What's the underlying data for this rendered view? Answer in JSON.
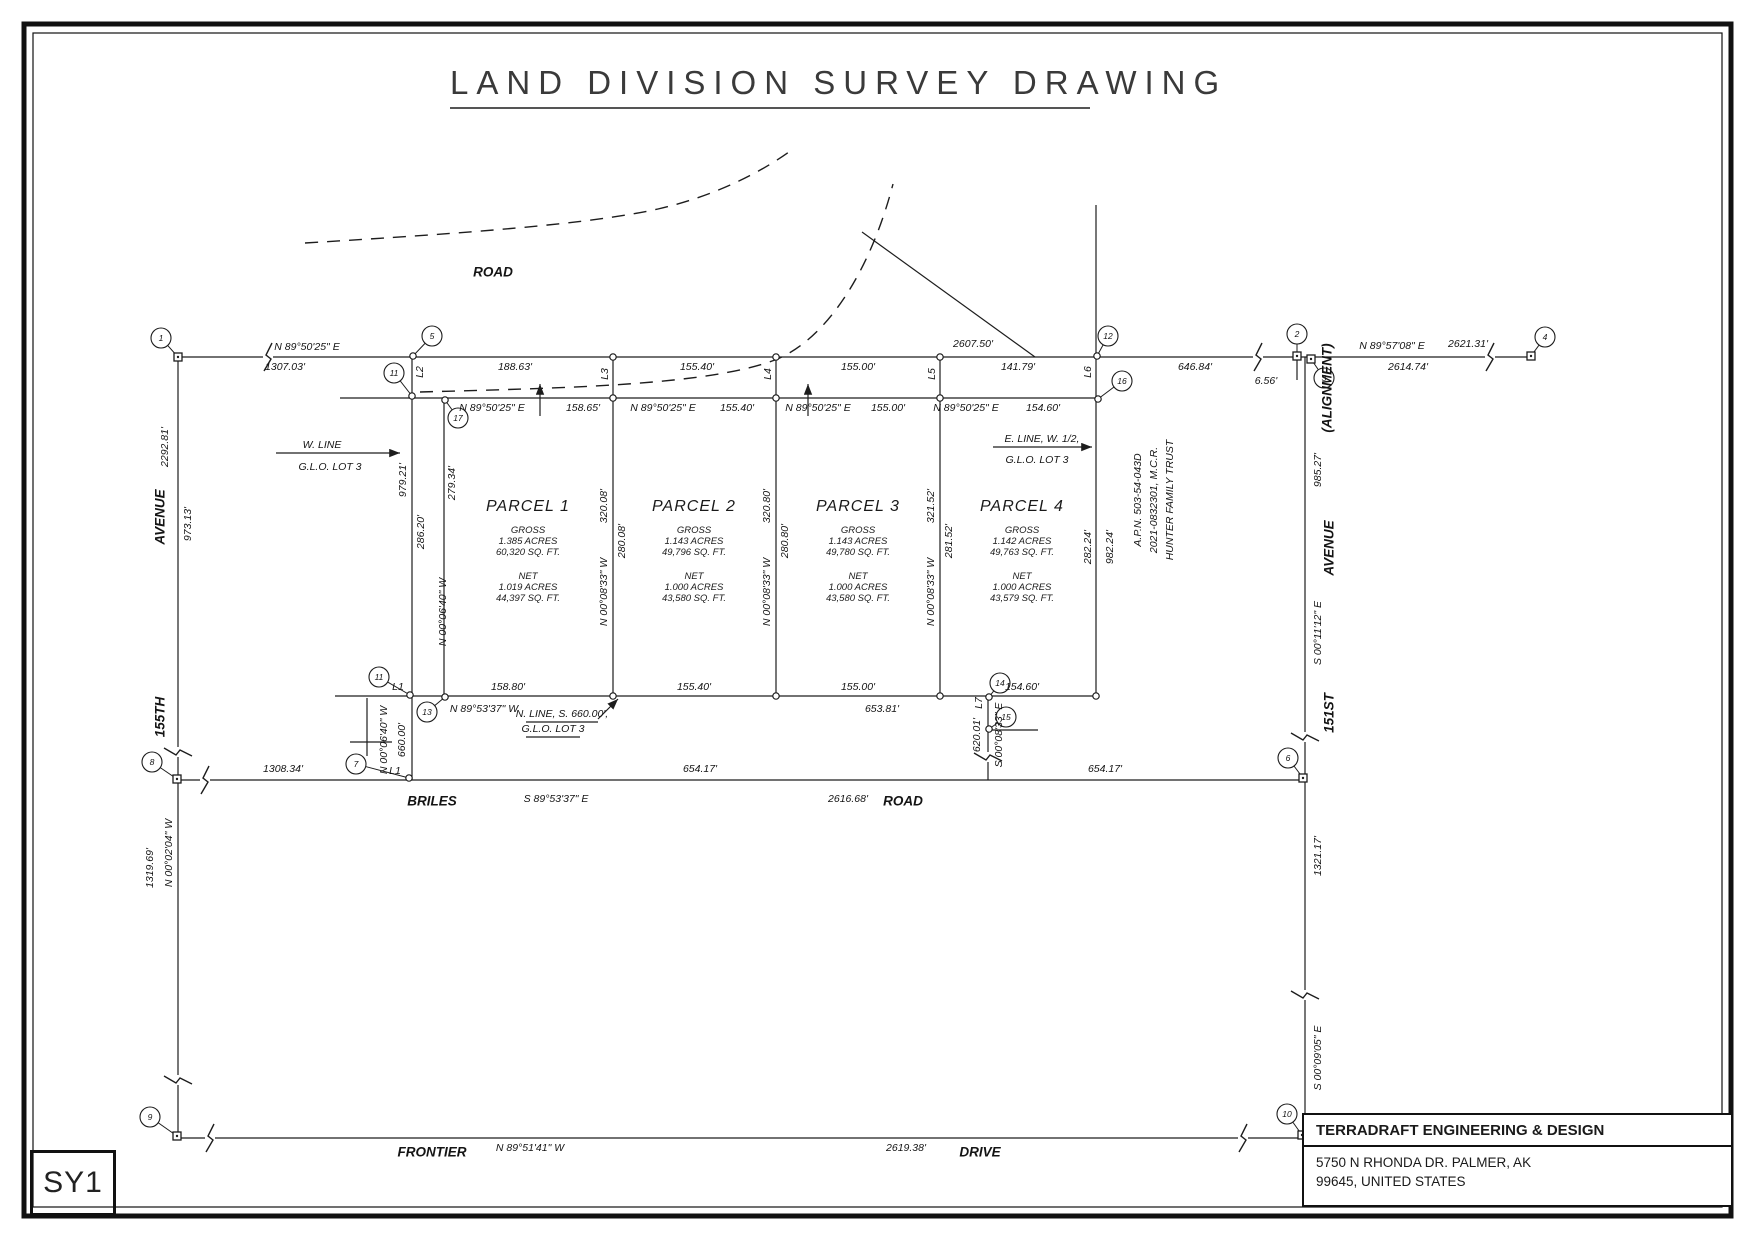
{
  "title": "LAND DIVISION SURVEY DRAWING",
  "sheet_id": "SY1",
  "title_block": {
    "company": "TERRADRAFT ENGINEERING & DESIGN",
    "address_line1": "5750 N RHONDA DR. PALMER, AK",
    "address_line2": "99645, UNITED STATES"
  },
  "colors": {
    "ink": "#1d1d1d",
    "paper": "#ffffff"
  },
  "parcels": [
    {
      "name": "PARCEL 1",
      "cx": 528,
      "gross": [
        "GROSS",
        "1.385 ACRES",
        "60,320 SQ. FT."
      ],
      "net": [
        "NET",
        "1.019 ACRES",
        "44,397 SQ. FT."
      ]
    },
    {
      "name": "PARCEL 2",
      "cx": 694,
      "gross": [
        "GROSS",
        "1.143 ACRES",
        "49,796 SQ. FT."
      ],
      "net": [
        "NET",
        "1.000 ACRES",
        "43,580 SQ. FT."
      ]
    },
    {
      "name": "PARCEL 3",
      "cx": 858,
      "gross": [
        "GROSS",
        "1.143 ACRES",
        "49,780 SQ. FT."
      ],
      "net": [
        "NET",
        "1.000 ACRES",
        "43,580 SQ. FT."
      ]
    },
    {
      "name": "PARCEL 4",
      "cx": 1022,
      "gross": [
        "GROSS",
        "1.142 ACRES",
        "49,763 SQ. FT."
      ],
      "net": [
        "NET",
        "1.000 ACRES",
        "43,579 SQ. FT."
      ]
    }
  ],
  "labels": [
    {
      "t": "ROAD",
      "x": 493,
      "y": 272,
      "c": "road",
      "n": "road-label-top"
    },
    {
      "t": "N 89°50'25\" E",
      "x": 307,
      "y": 347
    },
    {
      "t": "1307.03'",
      "x": 285,
      "y": 367
    },
    {
      "t": "188.63'",
      "x": 515,
      "y": 367
    },
    {
      "t": "155.40'",
      "x": 697,
      "y": 367
    },
    {
      "t": "155.00'",
      "x": 858,
      "y": 367
    },
    {
      "t": "141.79'",
      "x": 1018,
      "y": 367
    },
    {
      "t": "2607.50'",
      "x": 973,
      "y": 344
    },
    {
      "t": "646.84'",
      "x": 1195,
      "y": 367
    },
    {
      "t": "N 89°57'08\" E",
      "x": 1392,
      "y": 346
    },
    {
      "t": "2621.31'",
      "x": 1468,
      "y": 344
    },
    {
      "t": "2614.74'",
      "x": 1408,
      "y": 367
    },
    {
      "t": "6.56'",
      "x": 1266,
      "y": 381
    },
    {
      "t": "N 89°50'25\" E",
      "x": 492,
      "y": 408
    },
    {
      "t": "158.65'",
      "x": 583,
      "y": 408
    },
    {
      "t": "N 89°50'25\" E",
      "x": 663,
      "y": 408
    },
    {
      "t": "155.40'",
      "x": 737,
      "y": 408
    },
    {
      "t": "N 89°50'25\" E",
      "x": 818,
      "y": 408
    },
    {
      "t": "155.00'",
      "x": 888,
      "y": 408
    },
    {
      "t": "N 89°50'25\" E",
      "x": 966,
      "y": 408
    },
    {
      "t": "154.60'",
      "x": 1043,
      "y": 408
    },
    {
      "t": "L2",
      "x": 420,
      "y": 372,
      "r": 1
    },
    {
      "t": "L3",
      "x": 605,
      "y": 374,
      "r": 1
    },
    {
      "t": "L4",
      "x": 768,
      "y": 374,
      "r": 1
    },
    {
      "t": "L5",
      "x": 932,
      "y": 374,
      "r": 1
    },
    {
      "t": "L6",
      "x": 1088,
      "y": 372,
      "r": 1
    },
    {
      "t": "W. LINE",
      "x": 322,
      "y": 445
    },
    {
      "t": "G.L.O.  LOT 3",
      "x": 330,
      "y": 467
    },
    {
      "t": "E. LINE, W. 1/2,",
      "x": 1042,
      "y": 439
    },
    {
      "t": "G.L.O.  LOT 3",
      "x": 1037,
      "y": 460
    },
    {
      "t": "N. LINE, S. 660.00',",
      "x": 562,
      "y": 714
    },
    {
      "t": "G.L.O. LOT 3",
      "x": 553,
      "y": 729
    },
    {
      "t": "979.21'",
      "x": 403,
      "y": 480,
      "r": 1
    },
    {
      "t": "286.20'",
      "x": 421,
      "y": 532,
      "r": 1
    },
    {
      "t": "279.34'",
      "x": 452,
      "y": 483,
      "r": 1
    },
    {
      "t": "N 00°06'40\" W",
      "x": 443,
      "y": 612,
      "r": 1
    },
    {
      "t": "320.08'",
      "x": 604,
      "y": 506,
      "r": 1
    },
    {
      "t": "280.08'",
      "x": 622,
      "y": 541,
      "r": 1
    },
    {
      "t": "N 00°08'33\" W",
      "x": 604,
      "y": 592,
      "r": 1
    },
    {
      "t": "320.80'",
      "x": 767,
      "y": 506,
      "r": 1
    },
    {
      "t": "280.80'",
      "x": 785,
      "y": 541,
      "r": 1
    },
    {
      "t": "N 00°08'33\" W",
      "x": 767,
      "y": 592,
      "r": 1
    },
    {
      "t": "321.52'",
      "x": 931,
      "y": 506,
      "r": 1
    },
    {
      "t": "281.52'",
      "x": 949,
      "y": 541,
      "r": 1
    },
    {
      "t": "N 00°08'33\" W",
      "x": 931,
      "y": 592,
      "r": 1
    },
    {
      "t": "282.24'",
      "x": 1088,
      "y": 547,
      "r": 1
    },
    {
      "t": "982.24'",
      "x": 1110,
      "y": 547,
      "r": 1
    },
    {
      "t": "A.P.N. 503-54-043D",
      "x": 1138,
      "y": 500,
      "r": 1
    },
    {
      "t": "2021-0832301, M.C.R.",
      "x": 1154,
      "y": 500,
      "r": 1
    },
    {
      "t": "HUNTER FAMILY TRUST",
      "x": 1170,
      "y": 500,
      "r": 1
    },
    {
      "t": "L1",
      "x": 398,
      "y": 687
    },
    {
      "t": "158.80'",
      "x": 508,
      "y": 687
    },
    {
      "t": "N 89°53'37\" W",
      "x": 484,
      "y": 709
    },
    {
      "t": "155.40'",
      "x": 694,
      "y": 687
    },
    {
      "t": "155.00'",
      "x": 858,
      "y": 687
    },
    {
      "t": "154.60'",
      "x": 1022,
      "y": 687
    },
    {
      "t": "653.81'",
      "x": 882,
      "y": 709
    },
    {
      "t": "N 00°06'40\" W",
      "x": 384,
      "y": 740,
      "r": 1
    },
    {
      "t": "660.00'",
      "x": 402,
      "y": 740,
      "r": 1
    },
    {
      "t": "L7",
      "x": 979,
      "y": 703,
      "r": 1
    },
    {
      "t": "620.01'",
      "x": 977,
      "y": 735,
      "r": 1
    },
    {
      "t": "S 00°08'33\" E",
      "x": 999,
      "y": 735,
      "r": 1
    },
    {
      "t": "1308.34'",
      "x": 283,
      "y": 769
    },
    {
      "t": "L1",
      "x": 395,
      "y": 771
    },
    {
      "t": "BRILES",
      "x": 432,
      "y": 801,
      "c": "road",
      "n": "road-label-briles"
    },
    {
      "t": "S 89°53'37\" E",
      "x": 556,
      "y": 799
    },
    {
      "t": "654.17'",
      "x": 700,
      "y": 769
    },
    {
      "t": "2616.68'",
      "x": 848,
      "y": 799
    },
    {
      "t": "ROAD",
      "x": 903,
      "y": 801,
      "c": "road",
      "n": "road-label-briles-road"
    },
    {
      "t": "654.17'",
      "x": 1105,
      "y": 769
    },
    {
      "t": "2292.81'",
      "x": 165,
      "y": 447,
      "r": 1
    },
    {
      "t": "AVENUE",
      "x": 160,
      "y": 517,
      "r": 1,
      "c": "road",
      "n": "road-label-avenue-left"
    },
    {
      "t": "973.13'",
      "x": 188,
      "y": 524,
      "r": 1
    },
    {
      "t": "155TH",
      "x": 160,
      "y": 717,
      "r": 1,
      "c": "road",
      "n": "road-label-155th"
    },
    {
      "t": "N 00°02'04\" W",
      "x": 169,
      "y": 853,
      "r": 1
    },
    {
      "t": "1319.69'",
      "x": 150,
      "y": 868,
      "r": 1
    },
    {
      "t": "(ALIGNMENT)",
      "x": 1327,
      "y": 388,
      "r": 1,
      "c": "road",
      "n": "alignment-label"
    },
    {
      "t": "985.27'",
      "x": 1318,
      "y": 470,
      "r": 1
    },
    {
      "t": "AVENUE",
      "x": 1329,
      "y": 548,
      "r": 1,
      "c": "road",
      "n": "road-label-avenue-right"
    },
    {
      "t": "S 00°11'12\" E",
      "x": 1318,
      "y": 633,
      "r": 1
    },
    {
      "t": "151ST",
      "x": 1329,
      "y": 713,
      "r": 1,
      "c": "road",
      "n": "road-label-151st"
    },
    {
      "t": "1321.17'",
      "x": 1318,
      "y": 856,
      "r": 1
    },
    {
      "t": "S 00°09'05\" E",
      "x": 1318,
      "y": 1058,
      "r": 1
    },
    {
      "t": "FRONTIER",
      "x": 432,
      "y": 1152,
      "c": "road",
      "n": "road-label-frontier"
    },
    {
      "t": "N 89°51'41\" W",
      "x": 530,
      "y": 1148
    },
    {
      "t": "2619.38'",
      "x": 906,
      "y": 1148
    },
    {
      "t": "DRIVE",
      "x": 980,
      "y": 1152,
      "c": "road",
      "n": "road-label-drive"
    }
  ],
  "markers": [
    {
      "n": "1",
      "cx": 161,
      "cy": 338,
      "px": 178,
      "py": 357,
      "sq": 1
    },
    {
      "n": "5",
      "cx": 432,
      "cy": 336,
      "px": 413,
      "py": 356
    },
    {
      "n": "11",
      "cx": 394,
      "cy": 373,
      "px": 412,
      "py": 396
    },
    {
      "n": "17",
      "cx": 458,
      "cy": 418,
      "px": 445,
      "py": 400
    },
    {
      "n": "12",
      "cx": 1108,
      "cy": 336,
      "px": 1097,
      "py": 356
    },
    {
      "n": "16",
      "cx": 1122,
      "cy": 381,
      "px": 1098,
      "py": 399
    },
    {
      "n": "2",
      "cx": 1297,
      "cy": 334,
      "px": 1297,
      "py": 356,
      "sq": 1
    },
    {
      "n": "3",
      "cx": 1324,
      "cy": 378,
      "px": 1311,
      "py": 359,
      "sq": 1
    },
    {
      "n": "4",
      "cx": 1545,
      "cy": 337,
      "px": 1531,
      "py": 356,
      "sq": 1
    },
    {
      "n": "11",
      "cx": 379,
      "cy": 677,
      "px": 410,
      "py": 695
    },
    {
      "n": "13",
      "cx": 427,
      "cy": 712,
      "px": 445,
      "py": 697
    },
    {
      "n": "14",
      "cx": 1000,
      "cy": 683,
      "px": 989,
      "py": 697
    },
    {
      "n": "15",
      "cx": 1006,
      "cy": 717,
      "px": 989,
      "py": 729
    },
    {
      "n": "7",
      "cx": 356,
      "cy": 764,
      "px": 409,
      "py": 778
    },
    {
      "n": "8",
      "cx": 152,
      "cy": 762,
      "px": 177,
      "py": 779,
      "sq": 1
    },
    {
      "n": "6",
      "cx": 1288,
      "cy": 758,
      "px": 1303,
      "py": 778,
      "sq": 1
    },
    {
      "n": "9",
      "cx": 150,
      "cy": 1117,
      "px": 177,
      "py": 1136,
      "sq": 1
    },
    {
      "n": "10",
      "cx": 1287,
      "cy": 1114,
      "px": 1302,
      "py": 1135,
      "sq": 1
    }
  ]
}
